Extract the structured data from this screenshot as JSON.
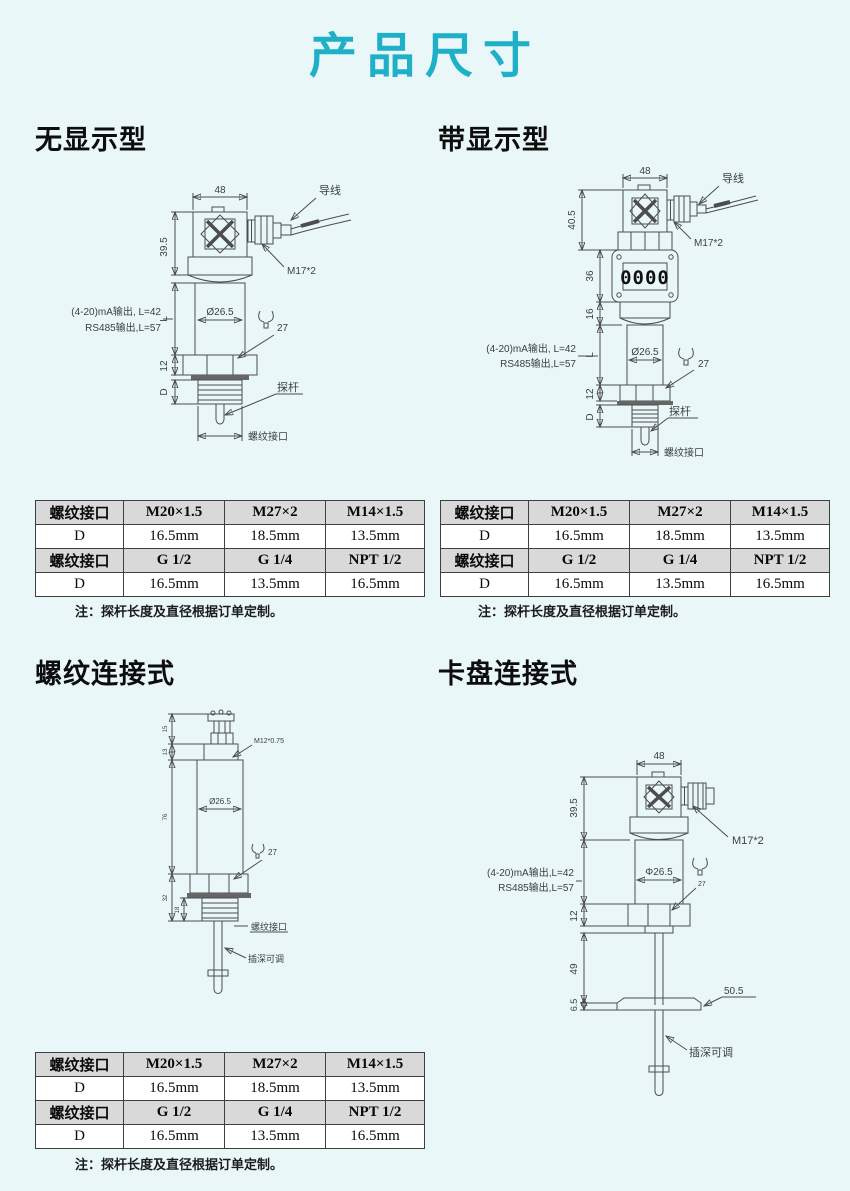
{
  "page": {
    "title": "产品尺寸",
    "bg": "#e9f7f9",
    "accent": "#1fb0c7"
  },
  "sections": {
    "no_display": "无显示型",
    "with_display": "带显示型",
    "threaded": "螺纹连接式",
    "chuck": "卡盘连接式"
  },
  "spec_table": {
    "rows": [
      {
        "label": "螺纹接口",
        "v1": "M20×1.5",
        "v2": "M27×2",
        "v3": "M14×1.5"
      },
      {
        "label": "D",
        "v1": "16.5mm",
        "v2": "18.5mm",
        "v3": "13.5mm"
      },
      {
        "label": "螺纹接口",
        "v1": "G 1/2",
        "v2": "G 1/4",
        "v3": "NPT 1/2"
      },
      {
        "label": "D",
        "v1": "16.5mm",
        "v2": "13.5mm",
        "v3": "16.5mm"
      }
    ],
    "note": "注：探杆长度及直径根据订单定制。"
  },
  "d1": {
    "dim48": "48",
    "wire": "导线",
    "dim395": "39.5",
    "m17": "M17*2",
    "out1": "(4-20)mA输出, L=42",
    "out2": "RS485输出,L=57",
    "dimL": "L",
    "dia": "Ø26.5",
    "hex27": "27",
    "dim12": "12",
    "dimD": "D",
    "probe": "探杆",
    "port": "螺纹接口"
  },
  "d2": {
    "dim48": "48",
    "wire": "导线",
    "dim405": "40.5",
    "m17": "M17*2",
    "dim36": "36",
    "lcd": "0000",
    "dim16": "16",
    "out1": "(4-20)mA输出, L=42",
    "out2": "RS485输出,L=57",
    "dimL": "L",
    "dia": "Ø26.5",
    "hex27": "27",
    "dim12": "12",
    "dimD": "D",
    "probe": "探杆",
    "port": "螺纹接口"
  },
  "d3": {
    "m12": "M12*0.75",
    "dia": "Ø26.5",
    "hex27": "27",
    "port": "螺纹接口",
    "adj": "插深可调",
    "dimA": "15",
    "dimB": "13",
    "dimC": "76",
    "dimE": "32",
    "dimF": "18"
  },
  "d4": {
    "dim48": "48",
    "dim395": "39.5",
    "m17": "M17*2",
    "out1": "(4-20)mA输出,L=42",
    "out2": "RS485输出,L=57",
    "dia": "Φ26.5",
    "dim12": "12",
    "hex27": "27",
    "dim49": "49",
    "dim65": "6.5",
    "dim505": "50.5",
    "adj": "插深可调"
  }
}
